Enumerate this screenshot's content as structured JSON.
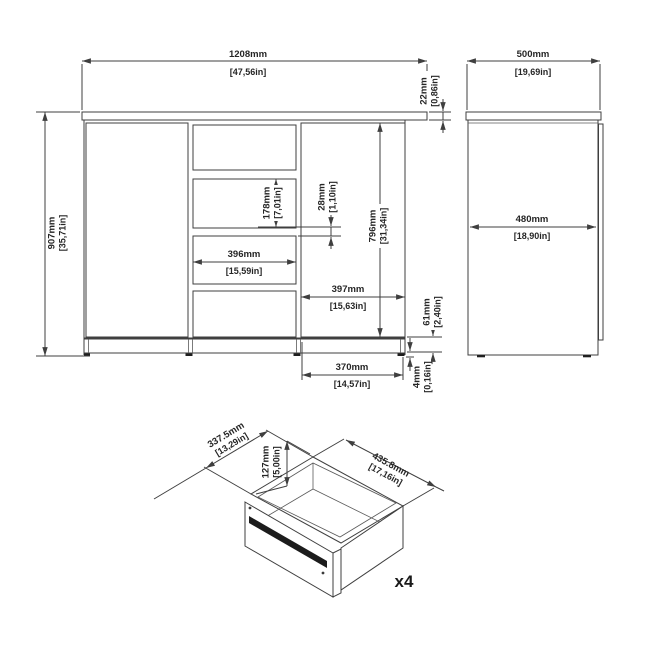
{
  "document": {
    "type": "furniture-dimension-drawing",
    "background_color": "#ffffff",
    "line_color": "#3f3f3f",
    "rail_color": "#1c1c1c"
  },
  "views": {
    "front": {
      "name": "front-elevation",
      "dims": {
        "overall_width": {
          "mm": "1208mm",
          "in": "[47,56in]"
        },
        "top_thickness": {
          "mm": "22mm",
          "in": "[0,86in]"
        },
        "overall_height": {
          "mm": "907mm",
          "in": "[35,71in]"
        },
        "middle_drawer_height": {
          "mm": "178mm",
          "in": "[7,01in]"
        },
        "drawer_gap": {
          "mm": "28mm",
          "in": "[1,10in]"
        },
        "door_height": {
          "mm": "796mm",
          "in": "[31,34in]"
        },
        "middle_drawer_width": {
          "mm": "396mm",
          "in": "[15,59in]"
        },
        "door_width": {
          "mm": "397mm",
          "in": "[15,63in]"
        },
        "plinth_height": {
          "mm": "61mm",
          "in": "[2,40in]"
        },
        "plinth_width": {
          "mm": "370mm",
          "in": "[14,57in]"
        },
        "foot_height": {
          "mm": "4mm",
          "in": "[0,16in]"
        }
      }
    },
    "side": {
      "name": "side-elevation",
      "dims": {
        "overall_depth": {
          "mm": "500mm",
          "in": "[19,69in]"
        },
        "body_depth": {
          "mm": "480mm",
          "in": "[18,90in]"
        }
      }
    },
    "drawer": {
      "name": "drawer-isometric-detail",
      "dims": {
        "inner_width": {
          "mm": "337.5mm",
          "in": "[13,29in]"
        },
        "inner_height": {
          "mm": "127mm",
          "in": "[5,00in]"
        },
        "inner_depth": {
          "mm": "435.8mm",
          "in": "[17,16in]"
        }
      },
      "quantity_label": "x4"
    }
  }
}
